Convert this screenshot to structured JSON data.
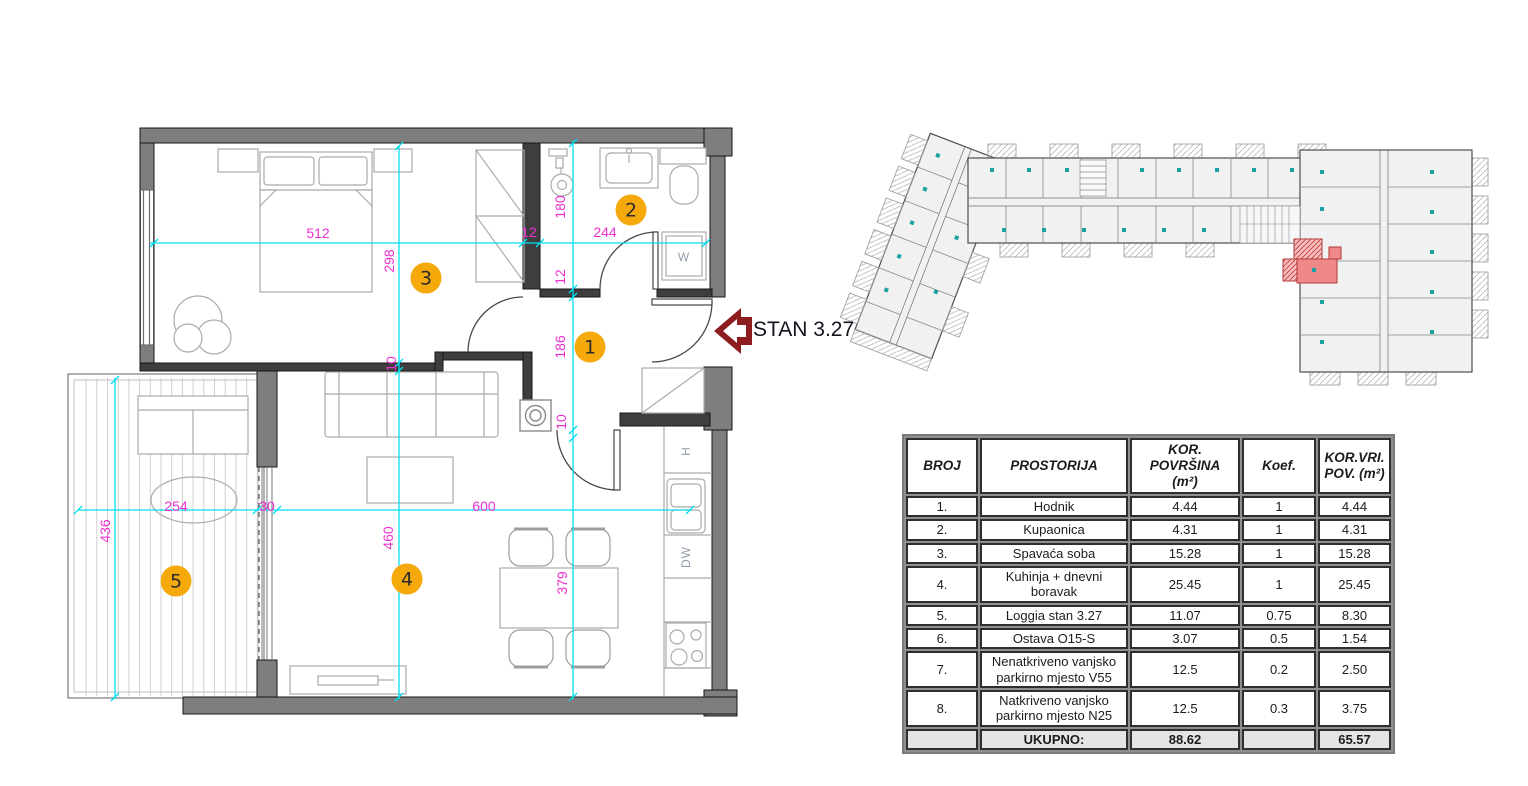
{
  "unit_label": {
    "text": "STAN 3.27"
  },
  "floor_plan": {
    "room_markers": [
      {
        "label": "1",
        "x": 590,
        "y": 347
      },
      {
        "label": "2",
        "x": 631,
        "y": 210
      },
      {
        "label": "3",
        "x": 426,
        "y": 278
      },
      {
        "label": "4",
        "x": 407,
        "y": 579
      },
      {
        "label": "5",
        "x": 176,
        "y": 581
      }
    ],
    "dimension_labels": [
      {
        "text": "512",
        "x": 318,
        "y": 233,
        "rot": false
      },
      {
        "text": "12",
        "x": 529,
        "y": 232,
        "rot": false
      },
      {
        "text": "244",
        "x": 605,
        "y": 232,
        "rot": false
      },
      {
        "text": "298",
        "x": 389,
        "y": 261,
        "rot": true
      },
      {
        "text": "10",
        "x": 391,
        "y": 364,
        "rot": true
      },
      {
        "text": "460",
        "x": 388,
        "y": 538,
        "rot": true
      },
      {
        "text": "180",
        "x": 560,
        "y": 207,
        "rot": true
      },
      {
        "text": "12",
        "x": 560,
        "y": 277,
        "rot": true
      },
      {
        "text": "186",
        "x": 560,
        "y": 347,
        "rot": true
      },
      {
        "text": "10",
        "x": 561,
        "y": 422,
        "rot": true
      },
      {
        "text": "379",
        "x": 562,
        "y": 583,
        "rot": true
      },
      {
        "text": "254",
        "x": 176,
        "y": 506,
        "rot": false
      },
      {
        "text": "30",
        "x": 267,
        "y": 506,
        "rot": false
      },
      {
        "text": "600",
        "x": 484,
        "y": 506,
        "rot": false
      },
      {
        "text": "436",
        "x": 105,
        "y": 531,
        "rot": true
      }
    ],
    "appliance_labels": [
      {
        "text": "W",
        "x": 684,
        "y": 257,
        "rot": false
      },
      {
        "text": "H",
        "x": 686,
        "y": 451,
        "rot": true
      },
      {
        "text": "DW",
        "x": 686,
        "y": 557,
        "rot": true
      }
    ]
  },
  "area_table": {
    "headers": [
      "BROJ",
      "PROSTORIJA",
      "KOR.\nPOVRŠINA\n(m²)",
      "Koef.",
      "KOR.VRI.\nPOV. (m²)"
    ],
    "rows": [
      [
        "1.",
        "Hodnik",
        "4.44",
        "1",
        "4.44"
      ],
      [
        "2.",
        "Kupaonica",
        "4.31",
        "1",
        "4.31"
      ],
      [
        "3.",
        "Spavaća soba",
        "15.28",
        "1",
        "15.28"
      ],
      [
        "4.",
        "Kuhinja + dnevni boravak",
        "25.45",
        "1",
        "25.45"
      ],
      [
        "5.",
        "Loggia stan 3.27",
        "11.07",
        "0.75",
        "8.30"
      ],
      [
        "6.",
        "Ostava O15-S",
        "3.07",
        "0.5",
        "1.54"
      ],
      [
        "7.",
        "Nenatkriveno vanjsko parkirno mjesto V55",
        "12.5",
        "0.2",
        "2.50"
      ],
      [
        "8.",
        "Natkriveno vanjsko parkirno mjesto N25",
        "12.5",
        "0.3",
        "3.75"
      ]
    ],
    "total_row": [
      "",
      "UKUPNO:",
      "88.62",
      "",
      "65.57"
    ]
  },
  "colors": {
    "dimension_line": "#00dff0",
    "dimension_text": "#ef2ed2",
    "room_marker": "#f5a90b",
    "wall_fill": "#7e7e7e",
    "interior_wall": "#3e3e3e",
    "unit_highlight": "#ef8989",
    "highlight_stroke": "#b03a3a",
    "arrow_red": "#8e1d20",
    "overview_teal": "#1aa2a2"
  }
}
